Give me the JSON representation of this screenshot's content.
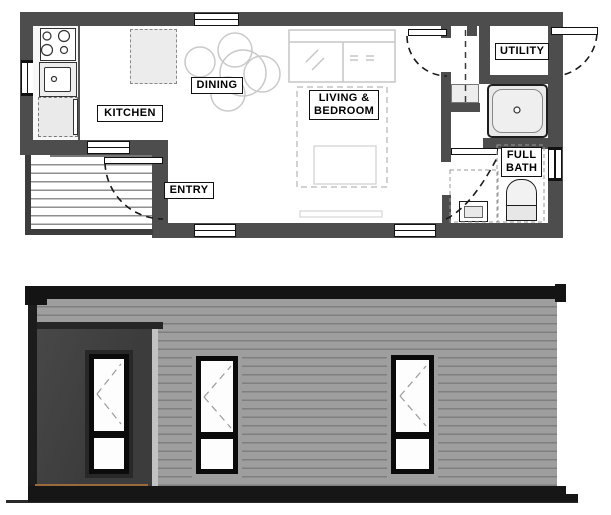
{
  "floor_plan": {
    "labels": {
      "kitchen": "KITCHEN",
      "dining": "DINING",
      "living_bedroom": "LIVING &\nBEDROOM",
      "entry": "ENTRY",
      "utility": "UTILITY",
      "full_bath": "FULL\nBATH"
    }
  },
  "colors": {
    "plan_wall": "#4d4d4d",
    "elevation_roof": "#141414",
    "elevation_siding": "#9e9e9e",
    "elevation_dark_panel": "#3f3f3f",
    "elevation_base": "#161616",
    "porch_floor_accent": "#9a6a3c",
    "fixture_fill": "#e9e9e9"
  }
}
